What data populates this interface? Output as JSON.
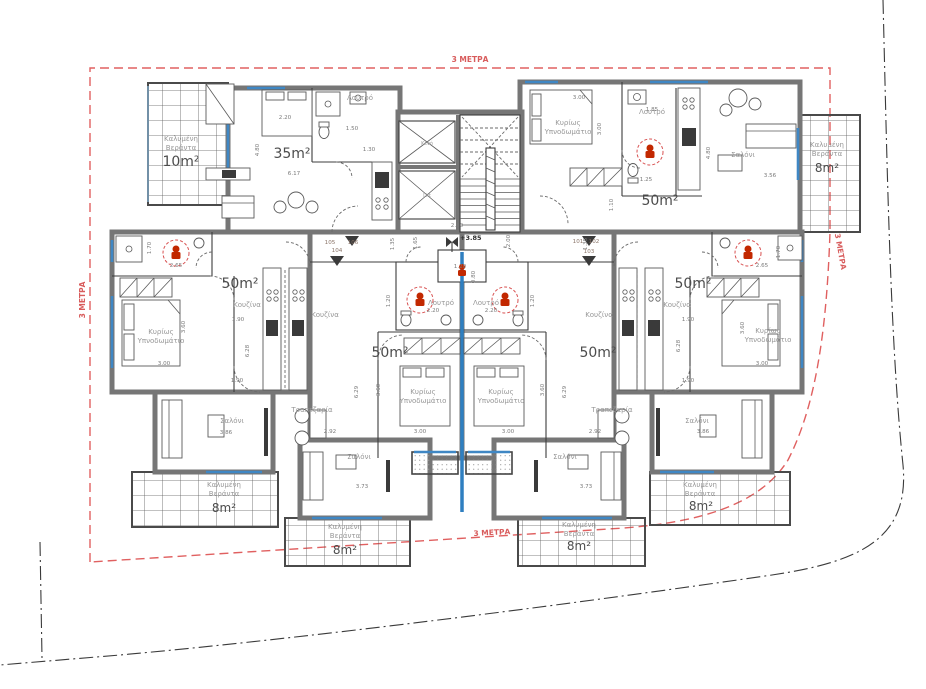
{
  "drawing": {
    "type": "architectural floor plan",
    "level_mark": "+3.85"
  },
  "labels": {
    "meters": "3 ΜΕΤΡΑ",
    "level": "+3.85",
    "veranda1": "Καλυμένη",
    "veranda2": "Βεράντα",
    "bed1": "Κυρίως",
    "bed2": "Υπνοδωμάτιο",
    "bath": "Λουτρό",
    "kitchen": "Κουζίνα",
    "living": "Σαλόνι",
    "dining": "Τραπεζαρία",
    "void": "Κενό",
    "lift": "Lift"
  },
  "areas": {
    "studio": "35m²",
    "apt": "50m²",
    "veranda10": "10m²",
    "veranda8": "8m²"
  },
  "units": {
    "u101": "101",
    "u102": "102",
    "u103": "103",
    "u104": "104",
    "u105": "105",
    "u106": "106"
  },
  "dims": {
    "d080": "0.80",
    "d110": "1.10",
    "d120": "1.20",
    "d125": "1.25",
    "d130": "1.30",
    "d135": "1.35",
    "d150": "1.50",
    "d165": "1.65",
    "d170": "1.70",
    "d185": "1.85",
    "d190": "1.90",
    "d200": "2.00",
    "d220": "2.20",
    "d260": "2.60",
    "d265": "2.65",
    "d292": "2.92",
    "d300": "3.00",
    "d356": "3.56",
    "d360": "3.60",
    "d373": "3.73",
    "d386": "3.86",
    "d480": "4.80",
    "d617": "6.17",
    "d628": "6.28",
    "d629": "6.29"
  },
  "colors": {
    "setback_red": "#e06060",
    "fixture_red": "#c22800",
    "window_blue": "#3f87c4",
    "wall_gray": "#767676",
    "boundary_black": "#3a3a3a"
  }
}
